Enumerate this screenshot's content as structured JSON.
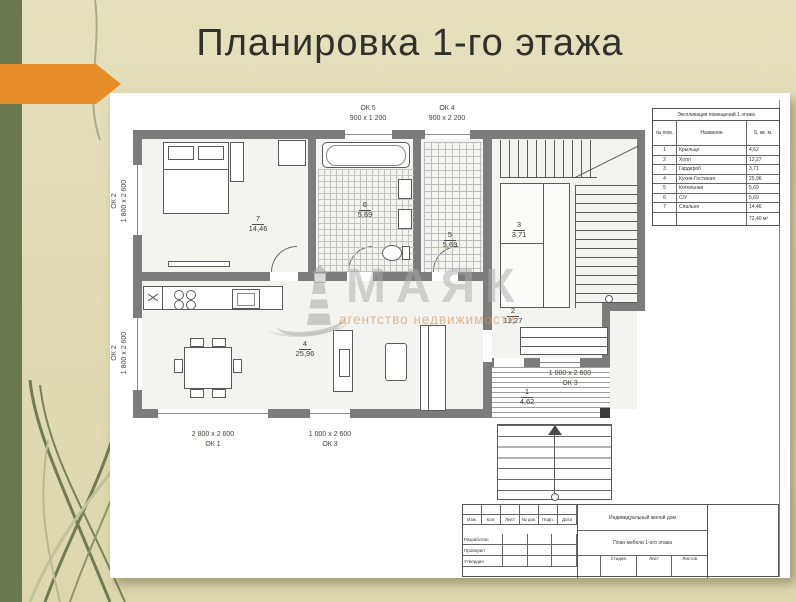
{
  "slide": {
    "title": "Планировка 1-го этажа"
  },
  "watermark": {
    "name": "МАЯК",
    "subtitle": "агентство недвижимости"
  },
  "colors": {
    "background": "#e2ddb8",
    "left_strip": "#6c7950",
    "arrow_orange": "#e78e2a",
    "wall_gray": "#7c7c7c",
    "watermark_gray": "#aaaaaa",
    "watermark_orange": "#ce945e"
  },
  "plan": {
    "rooms": {
      "r1": {
        "num": "1",
        "area": "4,62"
      },
      "r2": {
        "num": "2",
        "area": "12,27"
      },
      "r3": {
        "num": "3",
        "area": "3,71"
      },
      "r4": {
        "num": "4",
        "area": "25,96"
      },
      "r5": {
        "num": "5",
        "area": "5,69"
      },
      "r6": {
        "num": "6",
        "area": "5,69"
      },
      "r7": {
        "num": "7",
        "area": "14,46"
      }
    },
    "windows": {
      "ok5": {
        "mark": "ОК 5",
        "size": "900 x 1 200"
      },
      "ok4": {
        "mark": "ОК 4",
        "size": "900 x 2 200"
      },
      "ok2a": {
        "mark": "ОК 2",
        "size": "1 800 x 2 600"
      },
      "ok2b": {
        "mark": "ОК 2",
        "size": "1 800 x 2 600"
      },
      "ok1": {
        "mark": "ОК 1",
        "size": "2 800 x 2 600"
      },
      "ok3a": {
        "mark": "ОК 3",
        "size": "1 000 x 2 600"
      },
      "ok3b": {
        "mark": "ОК 3",
        "size": "1 000 x 2 600"
      }
    }
  },
  "legend_table": {
    "title": "Экспликация помещений 1 этажа",
    "columns": [
      "№ пом.",
      "Название",
      "S, кв. м."
    ],
    "rows": [
      [
        "1",
        "Крыльцо",
        "4,62"
      ],
      [
        "2",
        "Холл",
        "12,27"
      ],
      [
        "3",
        "Гардероб",
        "3,71"
      ],
      [
        "4",
        "Кухня-Гостиная",
        "25,96"
      ],
      [
        "5",
        "Котельная",
        "5,69"
      ],
      [
        "6",
        "С/У",
        "5,69"
      ],
      [
        "7",
        "Спальня",
        "14,46"
      ]
    ],
    "total": "72,40 м²"
  },
  "title_block": {
    "project": "Индивидуальный жилой дом",
    "sheet_title": "План мебели 1-ого этажа",
    "rev_headers": [
      "Изм.",
      "Кол.",
      "Лист",
      "№ док.",
      "Подп.",
      "Дата"
    ],
    "sign_rows": [
      "Разработал",
      "Проверил",
      "Утвердил"
    ],
    "stage_headers": [
      "Стадия",
      "Лист",
      "Листов"
    ]
  }
}
